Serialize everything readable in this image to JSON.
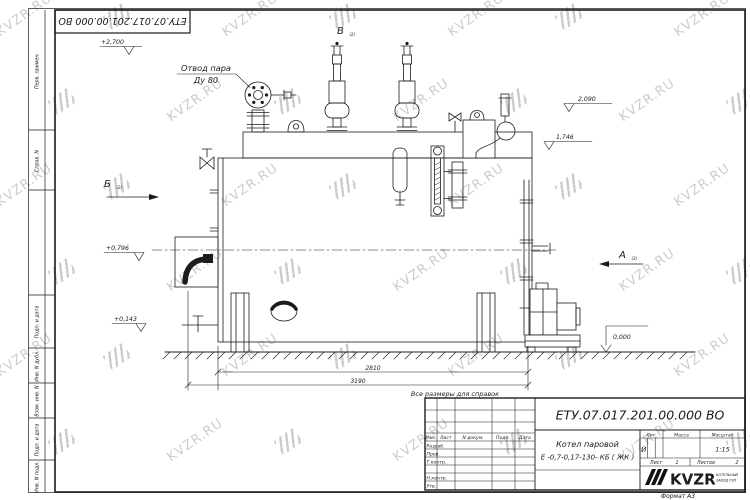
{
  "watermark": {
    "text": "KVZR.RU"
  },
  "sheet": {
    "doc_number": "ЕТУ.07.017.201.00.000  ВО",
    "format_label": "Формат А3",
    "reference_note": "Все размеры для справок"
  },
  "frame_columns": [
    {
      "label": "Перв. примен."
    },
    {
      "label": "Справ. N"
    },
    {
      "label": "Подп. и дата"
    },
    {
      "label": "Инв. N дубл."
    },
    {
      "label": "Взам. инв. N"
    },
    {
      "label": "Подп. и дата"
    },
    {
      "label": "Инв. N подл."
    }
  ],
  "title_block": {
    "doc_number": "ЕТУ.07.017.201.00.000  ВО",
    "product_name_line1": "Котел паровой",
    "product_name_line2": "Е -0,7-0,17-130- КБ ( ЖК )",
    "columns": {
      "izm": "Изм.",
      "list": "Лист",
      "doc": "N докум.",
      "podp": "Подп.",
      "data": "Дата"
    },
    "rows": {
      "razrab": "Разраб.",
      "prov": "Пров.",
      "tkontr": "Т.контр.",
      "nkontr": "Н.контр.",
      "utv": "Утв."
    },
    "lit_label": "Лит.",
    "mass_label": "Масса",
    "scale_label": "Масштаб",
    "lit_value": "И",
    "scale_value": "1:15",
    "sheet_label": "Лист",
    "sheet_value": "1",
    "sheets_label": "Листов",
    "sheets_value": "2",
    "logo_text": "KVZR",
    "logo_sub_line1": "КОТЕЛЬНЫЙ",
    "logo_sub_line2": "ЗАВОД РЭП"
  },
  "annotations": {
    "steam_outlet_line1": "Отвод пара",
    "steam_outlet_line2": "Ду 80",
    "view_b": "Б",
    "view_v": "В",
    "view_a": "А",
    "view_sheet_ref": "(2)",
    "elevations": {
      "top": "+2,700",
      "e2090": "2,090",
      "e1746": "1,746",
      "e0796": "+0,796",
      "e0143": "+0,143",
      "zero": "0,000"
    },
    "dim_2810": "2810",
    "dim_3190": "3190"
  }
}
